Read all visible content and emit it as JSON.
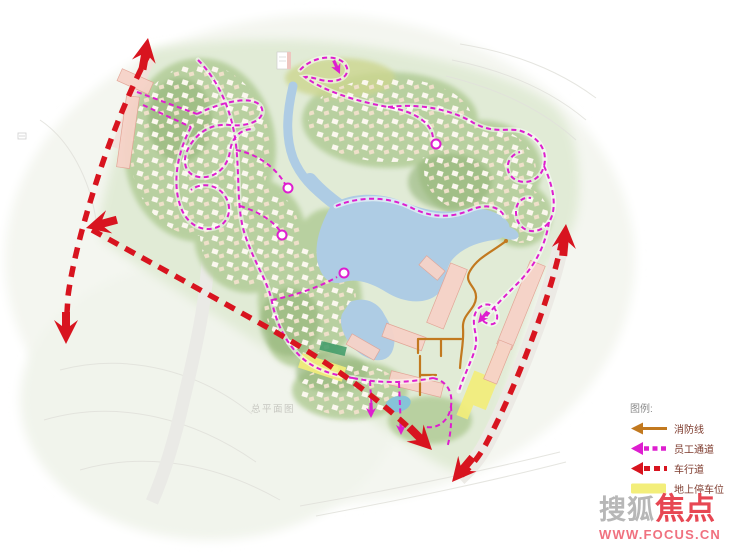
{
  "map": {
    "caption": "总平面图",
    "colors": {
      "vehicle_road_red": "#d8141f",
      "staff_passage_magenta": "#de1ecf",
      "fire_line_orange": "#c2791f",
      "parking_yellow": "#f3ee7a",
      "water_blue": "#aecce4",
      "terrain_green": "#e1ebd6",
      "building_pink": "#f6d2c8"
    }
  },
  "legend": {
    "title": "图例:",
    "items": [
      {
        "id": "fire-line",
        "label": "消防线",
        "color": "#c2791f",
        "style": "solid-arrow-line"
      },
      {
        "id": "staff-passage",
        "label": "员工通道",
        "color": "#de1ecf",
        "style": "dashed-arrow-line"
      },
      {
        "id": "vehicle-road",
        "label": "车行道",
        "color": "#d8141f",
        "style": "dashed-arrow-line"
      },
      {
        "id": "ground-parking",
        "label": "地上停车位",
        "color": "#f3ee7a",
        "style": "filled-area"
      }
    ]
  },
  "watermark": {
    "brand_primary": "搜狐",
    "brand_accent": "焦点",
    "url": "WWW.FOCUS.CN"
  }
}
